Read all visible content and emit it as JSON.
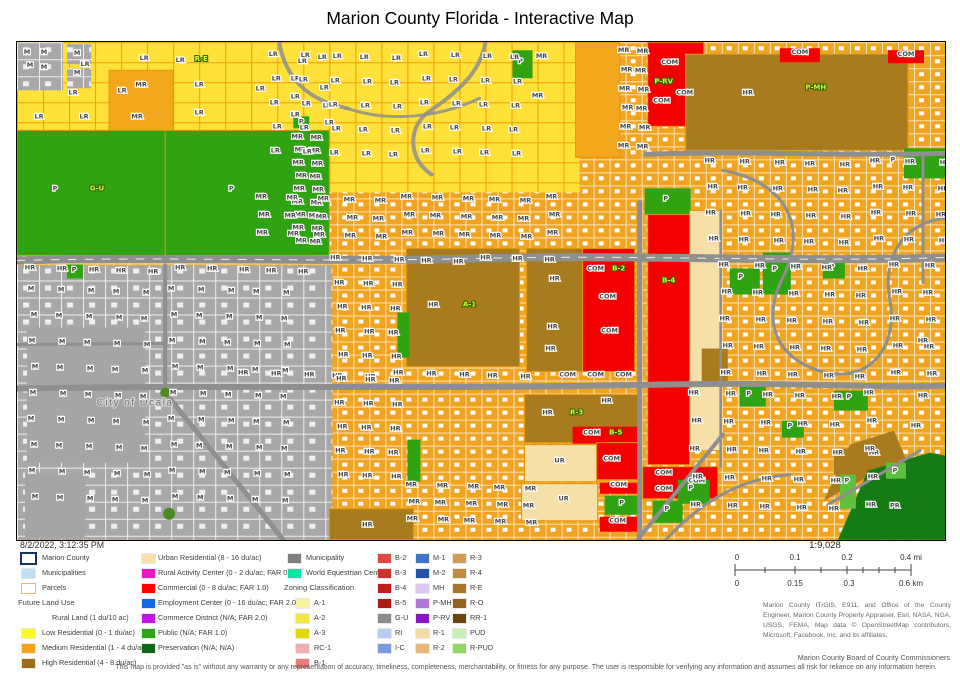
{
  "title": "Marion County Florida - Interactive Map",
  "timestamp": "8/2/2022, 3:12:35 PM",
  "board": "Marion County Board of County Commissioners",
  "disclaimer": "This map is provided \"as is\" without any warranty or any representation of accuracy, timeliness, completeness, merchantability, or fitness for any purpose.   The user is responsible for verifying any information and assumes all risk for reliance on any information herein.",
  "attribution": "Marion County IT/GIS, E911, and Office of the County Engineer, Marion County Property Appraiser, Esri, NASA, NGA, USGS, FEMA, Map data © OpenStreetMap contributors, Microsoft, Facebook, Inc. and its affiliates,",
  "scalebar": {
    "ratio": "1:9,028",
    "mi": [
      "0",
      "0.1",
      "0.2",
      "0.4 mi"
    ],
    "km": [
      "0",
      "0.15",
      "0.3",
      "0.6 km"
    ]
  },
  "colors": {
    "parcel_orange": "#F0A41F",
    "parcel_yellow": "#FFE13A",
    "public_green": "#2FA312",
    "commercial_red": "#F50000",
    "high_res_brown": "#A87C1E",
    "municipal_gray": "#A8A8A8",
    "urban_res_cream": "#F5E0AA",
    "preservation_green": "#157B15"
  },
  "legend": {
    "col1": [
      {
        "label": "Marion County",
        "swatch": {
          "fill": "#FFFFFF",
          "border": "#16355C",
          "bw": 2
        }
      },
      {
        "label": "Municipalities",
        "swatch": {
          "fill": "#BFE0F2"
        }
      },
      {
        "label": "Parcels",
        "swatch": {
          "fill": "#FFFFFF",
          "border": "#EDB96E",
          "bw": 1
        }
      },
      {
        "label": "Future Land Use",
        "heading": true
      },
      {
        "label": "Rural Land (1 du/10 ac)",
        "indent": true
      },
      {
        "label": "Low Residential (0 - 1 du/ac)",
        "swatch": {
          "fill": "#FFF52B"
        }
      },
      {
        "label": "Medium Residential (1 - 4 du/ac)",
        "swatch": {
          "fill": "#F7A11B"
        }
      },
      {
        "label": "High Residential (4 - 8 du/ac)",
        "swatch": {
          "fill": "#9E6B1A"
        }
      }
    ],
    "col2": [
      {
        "label": "Urban Residential (8 - 16 du/ac)",
        "swatch": {
          "fill": "#F7E0AE"
        }
      },
      {
        "label": "Rural Activity Center (0 - 2 du/ac; FAR 0.35)",
        "swatch": {
          "fill": "#F014C8"
        }
      },
      {
        "label": "Commercial (0 - 8 du/ac; FAR 1.0)",
        "swatch": {
          "fill": "#FF0000"
        }
      },
      {
        "label": "Employment Center (0 - 16 du/ac; FAR 2.0)",
        "swatch": {
          "fill": "#1668E3"
        }
      },
      {
        "label": "Commerce District (N/A; FAR 2.0)",
        "swatch": {
          "fill": "#C414E8"
        }
      },
      {
        "label": "Public (N/A; FAR 1.0)",
        "swatch": {
          "fill": "#2CA416"
        }
      },
      {
        "label": "Preservation (N/A; N/A)",
        "swatch": {
          "fill": "#0D6619"
        }
      }
    ],
    "col3": [
      {
        "label": "Municipality",
        "swatch": {
          "fill": "#7F7F7F"
        }
      },
      {
        "label": "World Equestrian Center",
        "swatch": {
          "fill": "#00E8A8"
        }
      },
      {
        "label": "Zoning Classification",
        "heading": true
      },
      {
        "label": "A-1",
        "swatch": {
          "fill": "#F7F2A3"
        },
        "indent": true
      },
      {
        "label": "A-2",
        "swatch": {
          "fill": "#F0E83E"
        },
        "indent": true
      },
      {
        "label": "A-3",
        "swatch": {
          "fill": "#E3D60E"
        },
        "indent": true
      },
      {
        "label": "RC-1",
        "swatch": {
          "fill": "#F2AFAD"
        },
        "indent": true
      },
      {
        "label": "B-1",
        "swatch": {
          "fill": "#E87C78"
        },
        "indent": true
      }
    ],
    "col4": [
      {
        "label": "B-2",
        "swatch": {
          "fill": "#DE4A45"
        }
      },
      {
        "label": "B-3",
        "swatch": {
          "fill": "#CC332E"
        }
      },
      {
        "label": "B-4",
        "swatch": {
          "fill": "#BD211C"
        }
      },
      {
        "label": "B-5",
        "swatch": {
          "fill": "#AB1A16"
        }
      },
      {
        "label": "G-U",
        "swatch": {
          "fill": "#8C8C8C"
        }
      },
      {
        "label": "RI",
        "swatch": {
          "fill": "#BACDF0"
        }
      },
      {
        "label": "I-C",
        "swatch": {
          "fill": "#7A9CDE"
        }
      }
    ],
    "col5": [
      {
        "label": "M-1",
        "swatch": {
          "fill": "#3E73C9"
        }
      },
      {
        "label": "M-2",
        "swatch": {
          "fill": "#2153AB"
        }
      },
      {
        "label": "MH",
        "swatch": {
          "fill": "#DCC8F2"
        }
      },
      {
        "label": "P-MH",
        "swatch": {
          "fill": "#B278D9"
        }
      },
      {
        "label": "P-RV",
        "swatch": {
          "fill": "#8A16C9"
        }
      },
      {
        "label": "R-1",
        "swatch": {
          "fill": "#F5DCA4"
        }
      },
      {
        "label": "R-2",
        "swatch": {
          "fill": "#E5BA79"
        }
      }
    ],
    "col6": [
      {
        "label": "R-3",
        "swatch": {
          "fill": "#D09C52"
        }
      },
      {
        "label": "R-4",
        "swatch": {
          "fill": "#BF8C3D"
        }
      },
      {
        "label": "R-E",
        "swatch": {
          "fill": "#A8762B"
        }
      },
      {
        "label": "R-O",
        "swatch": {
          "fill": "#91611E"
        }
      },
      {
        "label": "RR-1",
        "swatch": {
          "fill": "#6B4410"
        }
      },
      {
        "label": "PUD",
        "swatch": {
          "fill": "#C6F2B0"
        }
      },
      {
        "label": "R-PUD",
        "swatch": {
          "fill": "#8ED95F"
        }
      }
    ]
  },
  "map": {
    "labels": [
      [
        "M",
        10,
        12
      ],
      [
        "M",
        27,
        12
      ],
      [
        "M",
        13,
        25
      ],
      [
        "M",
        27,
        27
      ],
      [
        "M",
        60,
        13
      ],
      [
        "M",
        60,
        32
      ],
      [
        "LR",
        68,
        24
      ],
      [
        "LR",
        127,
        18
      ],
      [
        "LR",
        163,
        20
      ],
      [
        "LR",
        105,
        50
      ],
      [
        "LR",
        56,
        52
      ],
      [
        "LR",
        22,
        76
      ],
      [
        "LR",
        67,
        76
      ],
      [
        "LR",
        182,
        44
      ],
      [
        "LR",
        182,
        72
      ],
      [
        "LR",
        243,
        48
      ],
      [
        "R-E",
        184,
        19,
        1
      ],
      [
        "MR",
        124,
        44
      ],
      [
        "MR",
        120,
        76
      ],
      [
        "LR",
        285,
        21
      ],
      [
        "LR",
        305,
        17
      ],
      [
        "LR",
        278,
        38
      ],
      [
        "LR",
        307,
        47
      ],
      [
        "LR",
        278,
        56
      ],
      [
        "LR",
        310,
        65
      ],
      [
        "LR",
        278,
        74
      ],
      [
        "LR",
        312,
        82
      ],
      [
        "P",
        284,
        81
      ],
      [
        "P",
        38,
        148
      ],
      [
        "G-U",
        80,
        148,
        1
      ],
      [
        "P",
        214,
        148
      ],
      [
        "P",
        503,
        21
      ],
      [
        "MR",
        524,
        16
      ],
      [
        "MR",
        520,
        55
      ],
      [
        "COM",
        652,
        22
      ],
      [
        "P-RV",
        646,
        41,
        1
      ],
      [
        "COM",
        644,
        60
      ],
      [
        "COM",
        667,
        52
      ],
      [
        "COM",
        782,
        12
      ],
      [
        "COM",
        888,
        14
      ],
      [
        "HR",
        730,
        52
      ],
      [
        "P-MH",
        798,
        47,
        1
      ],
      [
        "P",
        648,
        158
      ],
      [
        "B-4",
        651,
        240,
        1
      ],
      [
        "P",
        723,
        236
      ],
      [
        "P",
        757,
        228
      ],
      [
        "P",
        731,
        353
      ],
      [
        "P",
        772,
        385
      ],
      [
        "P",
        831,
        356
      ],
      [
        "P",
        673,
        447
      ],
      [
        "P",
        875,
        119
      ],
      [
        "P",
        829,
        440
      ],
      [
        "P",
        877,
        430
      ],
      [
        "P",
        814,
        226
      ],
      [
        "P",
        57,
        229
      ],
      [
        "HR",
        416,
        264
      ],
      [
        "A-1",
        452,
        264,
        1
      ],
      [
        "HR",
        500,
        218
      ],
      [
        "HR",
        537,
        238
      ],
      [
        "HR",
        535,
        286
      ],
      [
        "HR",
        533,
        308
      ],
      [
        "COM",
        578,
        228
      ],
      [
        "B-2",
        601,
        228,
        1
      ],
      [
        "COM",
        590,
        256
      ],
      [
        "COM",
        592,
        290
      ],
      [
        "COM",
        550,
        334
      ],
      [
        "COM",
        578,
        334
      ],
      [
        "COM",
        606,
        334
      ],
      [
        "HR",
        530,
        372
      ],
      [
        "R-3",
        559,
        372,
        1
      ],
      [
        "HR",
        589,
        360
      ],
      [
        "COM",
        574,
        392
      ],
      [
        "B-5",
        598,
        392,
        1
      ],
      [
        "UR",
        542,
        420
      ],
      [
        "UR",
        546,
        458
      ],
      [
        "COM",
        594,
        418
      ],
      [
        "COM",
        601,
        444
      ],
      [
        "P",
        604,
        462
      ],
      [
        "COM",
        600,
        480
      ],
      [
        "COM",
        646,
        432
      ],
      [
        "COM",
        646,
        448
      ],
      [
        "COM",
        679,
        440
      ],
      [
        "P",
        649,
        468
      ],
      [
        "HR",
        350,
        484
      ],
      [
        "PR",
        877,
        465
      ],
      [
        "HR",
        856,
        412
      ],
      [
        "HR",
        905,
        300
      ],
      [
        "HR",
        905,
        355
      ],
      [
        "HR",
        898,
        385
      ],
      [
        "City of Ocala",
        118,
        363,
        2
      ]
    ],
    "label_grids": [
      {
        "t": "MR",
        "x0": 282,
        "y0": 98,
        "dx": 17,
        "dy": 13,
        "c": 2,
        "r": 9
      },
      {
        "t": "LR",
        "x0": 258,
        "y0": 16,
        "dx": 30,
        "dy": 24,
        "c": 9,
        "r": 5
      },
      {
        "t": "MR",
        "x0": 608,
        "y0": 12,
        "dx": 17,
        "dy": 19,
        "c": 2,
        "r": 6
      },
      {
        "t": "MR",
        "x0": 246,
        "y0": 158,
        "dx": 29,
        "dy": 18,
        "c": 11,
        "r": 3
      },
      {
        "t": "HR",
        "x0": 694,
        "y0": 122,
        "dx": 33,
        "dy": 26,
        "c": 8,
        "r": 4
      },
      {
        "t": "HR",
        "x0": 708,
        "y0": 226,
        "dx": 34,
        "dy": 27,
        "c": 7,
        "r": 5
      },
      {
        "t": "HR",
        "x0": 678,
        "y0": 354,
        "dx": 35,
        "dy": 28,
        "c": 6,
        "r": 5
      },
      {
        "t": "HR",
        "x0": 320,
        "y0": 219,
        "dx": 30,
        "dy": 20,
        "c": 8,
        "r": 1
      },
      {
        "t": "HR",
        "x0": 15,
        "y0": 229,
        "dx": 30,
        "dy": 20,
        "c": 10,
        "r": 1
      },
      {
        "t": "HR",
        "x0": 228,
        "y0": 334,
        "dx": 31,
        "dy": 20,
        "c": 10,
        "r": 1
      },
      {
        "t": "MR",
        "x0": 396,
        "y0": 446,
        "dx": 29,
        "dy": 17,
        "c": 5,
        "r": 3
      },
      {
        "t": "HR",
        "x0": 324,
        "y0": 244,
        "dx": 27,
        "dy": 24,
        "c": 3,
        "r": 9
      },
      {
        "t": "M",
        "x0": 16,
        "y0": 250,
        "dx": 28,
        "dy": 26,
        "c": 10,
        "r": 9
      }
    ]
  }
}
